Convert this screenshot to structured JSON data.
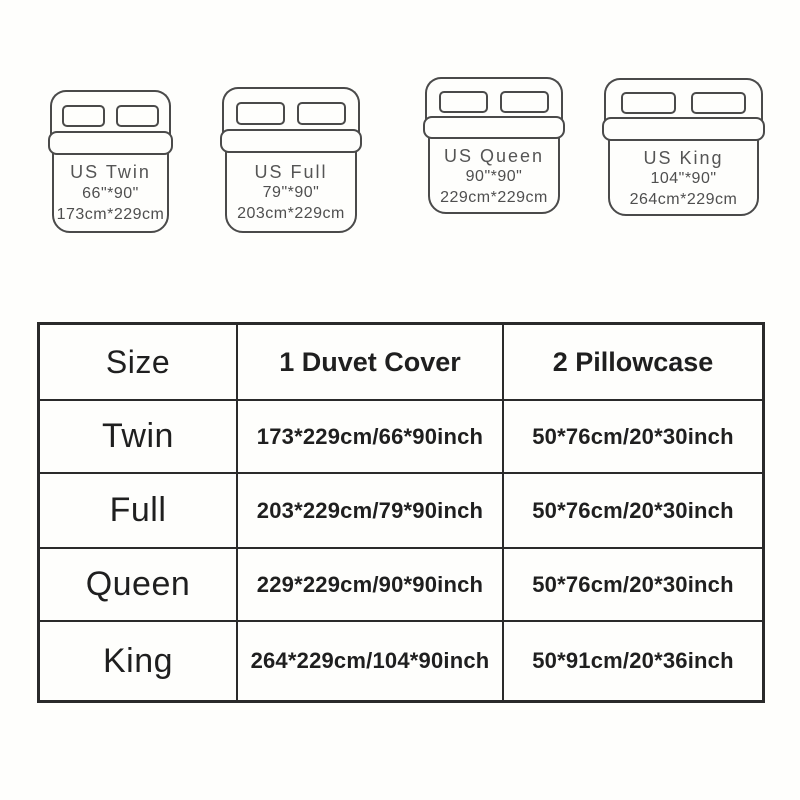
{
  "beds": [
    {
      "name": "US Twin",
      "inches": "66\"*90\"",
      "cm": "173cm*229cm"
    },
    {
      "name": "US Full",
      "inches": "79\"*90\"",
      "cm": "203cm*229cm"
    },
    {
      "name": "US Queen",
      "inches": "90\"*90\"",
      "cm": "229cm*229cm"
    },
    {
      "name": "US King",
      "inches": "104\"*90\"",
      "cm": "264cm*229cm"
    }
  ],
  "table": {
    "headers": [
      "Size",
      "1 Duvet Cover",
      "2 Pillowcase"
    ],
    "rows": [
      {
        "size": "Twin",
        "duvet": "173*229cm/66*90inch",
        "pillowcase": "50*76cm/20*30inch"
      },
      {
        "size": "Full",
        "duvet": "203*229cm/79*90inch",
        "pillowcase": "50*76cm/20*30inch"
      },
      {
        "size": "Queen",
        "duvet": "229*229cm/90*90inch",
        "pillowcase": "50*76cm/20*30inch"
      },
      {
        "size": "King",
        "duvet": "264*229cm/104*90inch",
        "pillowcase": "50*91cm/20*36inch"
      }
    ]
  },
  "colors": {
    "background": "#fefefc",
    "bed_outline": "#4a4a4a",
    "bed_text": "#555555",
    "table_border": "#2a2a2a",
    "table_text": "#1f1f1f"
  }
}
